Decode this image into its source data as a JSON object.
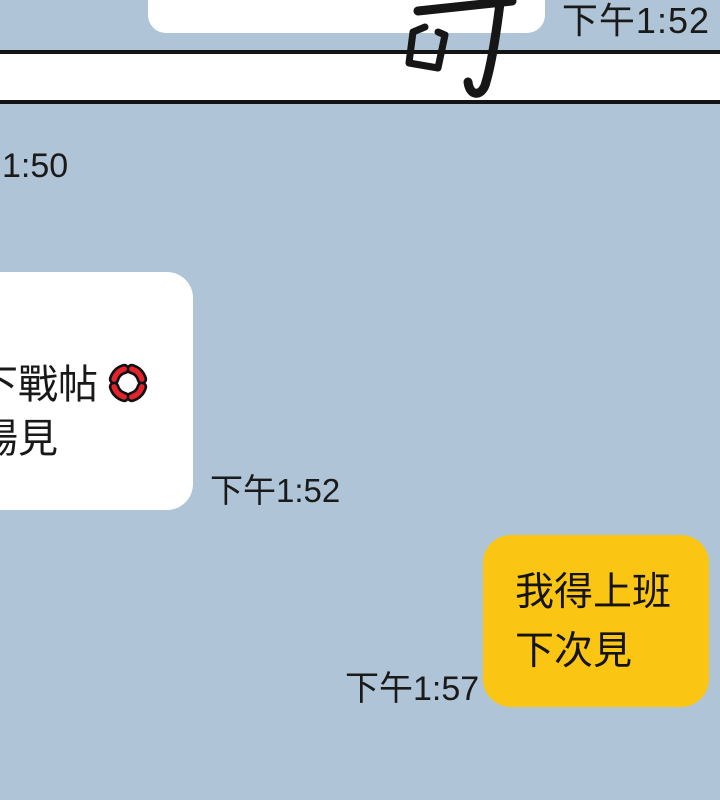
{
  "colors": {
    "panel_bg": "#B0C4D7",
    "incoming_bubble": "#FFFFFF",
    "outgoing_bubble": "#FBC513",
    "panel_border": "#141414",
    "text": "#1A1A1A",
    "anger_red": "#E3242B"
  },
  "top_panel": {
    "timestamp": "下午1:52"
  },
  "sound_effect": {
    "character": "叮"
  },
  "chat": {
    "timestamp_partial": "1:50",
    "incoming": {
      "line1": "下戰帖",
      "line2": "場見",
      "emoji": "anger-symbol",
      "timestamp": "下午1:52"
    },
    "outgoing": {
      "line1": "我得上班",
      "line2": "下次見",
      "timestamp": "下午1:57"
    }
  }
}
